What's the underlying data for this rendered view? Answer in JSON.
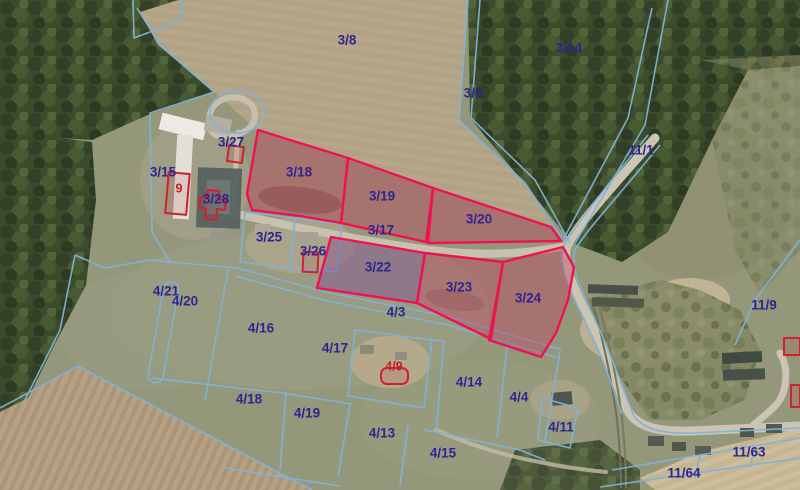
{
  "app": {
    "type": "cadastral-aerial-map-view"
  },
  "map": {
    "colors": {
      "parcel_label": "#2e2590",
      "building_label": "#c41f2a",
      "boundary_line": "#7fb3d9",
      "highlight_stroke": "#f01150",
      "highlight_fill": "rgba(193,62,94,0.40)",
      "highlight_fill_alt": "rgba(128,72,150,0.42)"
    },
    "parcel_labels": [
      {
        "text": "3/8",
        "x": 347,
        "y": 40
      },
      {
        "text": "3/9",
        "x": 473,
        "y": 93
      },
      {
        "text": "3/14",
        "x": 569,
        "y": 48
      },
      {
        "text": "11/1",
        "x": 641,
        "y": 150
      },
      {
        "text": "3/15",
        "x": 163,
        "y": 172
      },
      {
        "text": "3/27",
        "x": 231,
        "y": 142
      },
      {
        "text": "3/28",
        "x": 216,
        "y": 199
      },
      {
        "text": "3/18",
        "x": 299,
        "y": 172
      },
      {
        "text": "3/19",
        "x": 382,
        "y": 196
      },
      {
        "text": "3/17",
        "x": 381,
        "y": 230
      },
      {
        "text": "3/20",
        "x": 479,
        "y": 219
      },
      {
        "text": "3/25",
        "x": 269,
        "y": 237
      },
      {
        "text": "3/26",
        "x": 313,
        "y": 251
      },
      {
        "text": "3/22",
        "x": 378,
        "y": 267
      },
      {
        "text": "3/23",
        "x": 459,
        "y": 287
      },
      {
        "text": "3/24",
        "x": 528,
        "y": 298
      },
      {
        "text": "4/3",
        "x": 396,
        "y": 312
      },
      {
        "text": "4/21",
        "x": 166,
        "y": 291
      },
      {
        "text": "4/20",
        "x": 185,
        "y": 301
      },
      {
        "text": "4/16",
        "x": 261,
        "y": 328
      },
      {
        "text": "4/17",
        "x": 335,
        "y": 348
      },
      {
        "text": "4/18",
        "x": 249,
        "y": 399
      },
      {
        "text": "4/19",
        "x": 307,
        "y": 413
      },
      {
        "text": "4/13",
        "x": 382,
        "y": 433
      },
      {
        "text": "4/15",
        "x": 443,
        "y": 453
      },
      {
        "text": "4/14",
        "x": 469,
        "y": 382
      },
      {
        "text": "4/4",
        "x": 519,
        "y": 397
      },
      {
        "text": "4/11",
        "x": 561,
        "y": 427
      },
      {
        "text": "11/9",
        "x": 764,
        "y": 305
      },
      {
        "text": "11/63",
        "x": 749,
        "y": 452
      },
      {
        "text": "11/64",
        "x": 684,
        "y": 473
      }
    ],
    "building_labels": [
      {
        "text": "9",
        "x": 179,
        "y": 188
      },
      {
        "text": "4/9",
        "x": 394,
        "y": 366
      }
    ],
    "highlighted_parcels": [
      {
        "id": "3/18",
        "points": "258,130 348,158 341,223 300,216 252,210 247,194",
        "fill": "std"
      },
      {
        "id": "3/19",
        "points": "348,158 433,188 426,242 341,223",
        "fill": "std"
      },
      {
        "id": "3/20",
        "points": "433,188 551,227 561,241 428,243",
        "fill": "std"
      },
      {
        "id": "3/22",
        "points": "331,237 425,253 417,303 317,288",
        "fill": "alt"
      },
      {
        "id": "3/23",
        "points": "425,253 503,262 491,339 417,303",
        "fill": "std"
      },
      {
        "id": "3/24",
        "points": "503,262 563,247 574,267 568,300 556,333 541,357 489,340",
        "fill": "std"
      }
    ]
  }
}
